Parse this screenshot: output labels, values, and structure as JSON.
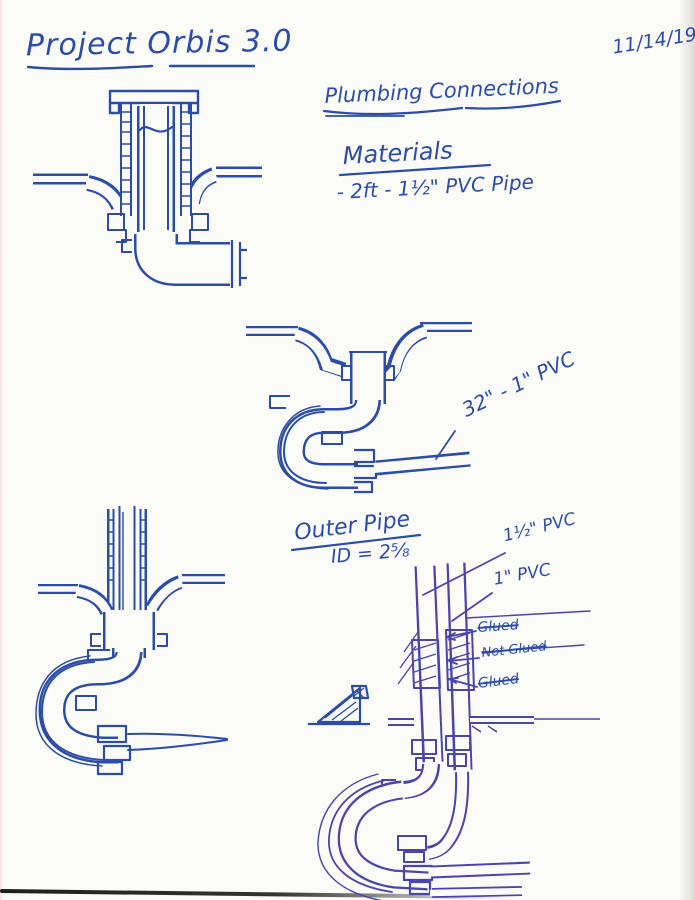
{
  "page": {
    "title": "Project Orbis 3.0",
    "date": "11/14/19"
  },
  "notes": {
    "heading": "Plumbing Connections",
    "materials_heading": "Materials",
    "materials_items": [
      "- 2ft - 1½\" PVC Pipe"
    ]
  },
  "callouts": {
    "pipe32": "32\" - 1\" PVC",
    "outer_pipe": "Outer Pipe",
    "outer_pipe_id": "ID = 2⅝",
    "pvc15": "1½\" PVC",
    "pvc1": "1\" PVC",
    "glued_top": "Glued",
    "not_glued": "Not Glued",
    "glued_bottom": "Glued"
  },
  "colors": {
    "ink_blue": "#2b4da9",
    "ink_violet": "#4a44ac",
    "paper": "#fbfbf8"
  }
}
